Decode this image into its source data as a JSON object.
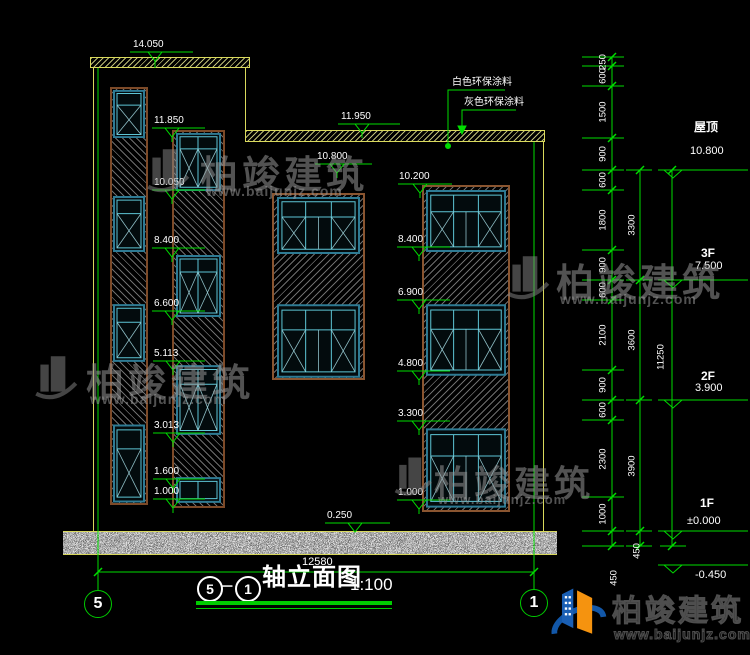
{
  "drawing": {
    "title": {
      "axis_left": "5",
      "separator": "－",
      "axis_right": "1",
      "name": "轴立面图",
      "scale": "1:100"
    },
    "axis_bubbles": {
      "left": "5",
      "right": "1"
    },
    "bottom_width_dim": "12580",
    "notes": {
      "white_paint": "白色环保涂料",
      "gray_paint": "灰色环保涂料"
    },
    "floors": {
      "roof_label": "屋顶",
      "roof_elev": "10.800",
      "f3_label": "3F",
      "f3_elev": "7.500",
      "f2_label": "2F",
      "f2_elev": "3.900",
      "f1_label": "1F",
      "f1_elev": "±0.000",
      "base_elev": "-0.450"
    },
    "elevation_markers": {
      "e14050": "14.050",
      "e11950": "11.950",
      "e11850": "11.850",
      "e10800": "10.800",
      "e10200": "10.200",
      "e10050": "10.050",
      "e8400": "8.400",
      "e6900": "6.900",
      "e6600": "6.600",
      "e5113": "5.113",
      "e4800": "4.800",
      "e3300": "3.300",
      "e3013": "3.013",
      "e1600": "1.600",
      "e1000": "1.000",
      "e0250": "0.250"
    },
    "dim_chain_outer": [
      "250",
      "600",
      "1500",
      "900",
      "600",
      "1800",
      "900",
      "600",
      "2100",
      "900",
      "600",
      "2300",
      "1000",
      "450"
    ],
    "dim_chain_mid": [
      "3300",
      "3600",
      "3900",
      "450"
    ],
    "dim_chain_total": "11250"
  },
  "watermark": {
    "brand": "柏竣建筑",
    "url": "www.baijunjz.com"
  },
  "logo": {
    "brand": "柏竣建筑",
    "url": "www.baijunjz.com"
  },
  "colors": {
    "line_green": "#00dd00",
    "line_yellow": "#d9d95c",
    "window_teal": "#5ec6d6",
    "wall_brown": "#7d4a28",
    "bg": "#000000"
  }
}
